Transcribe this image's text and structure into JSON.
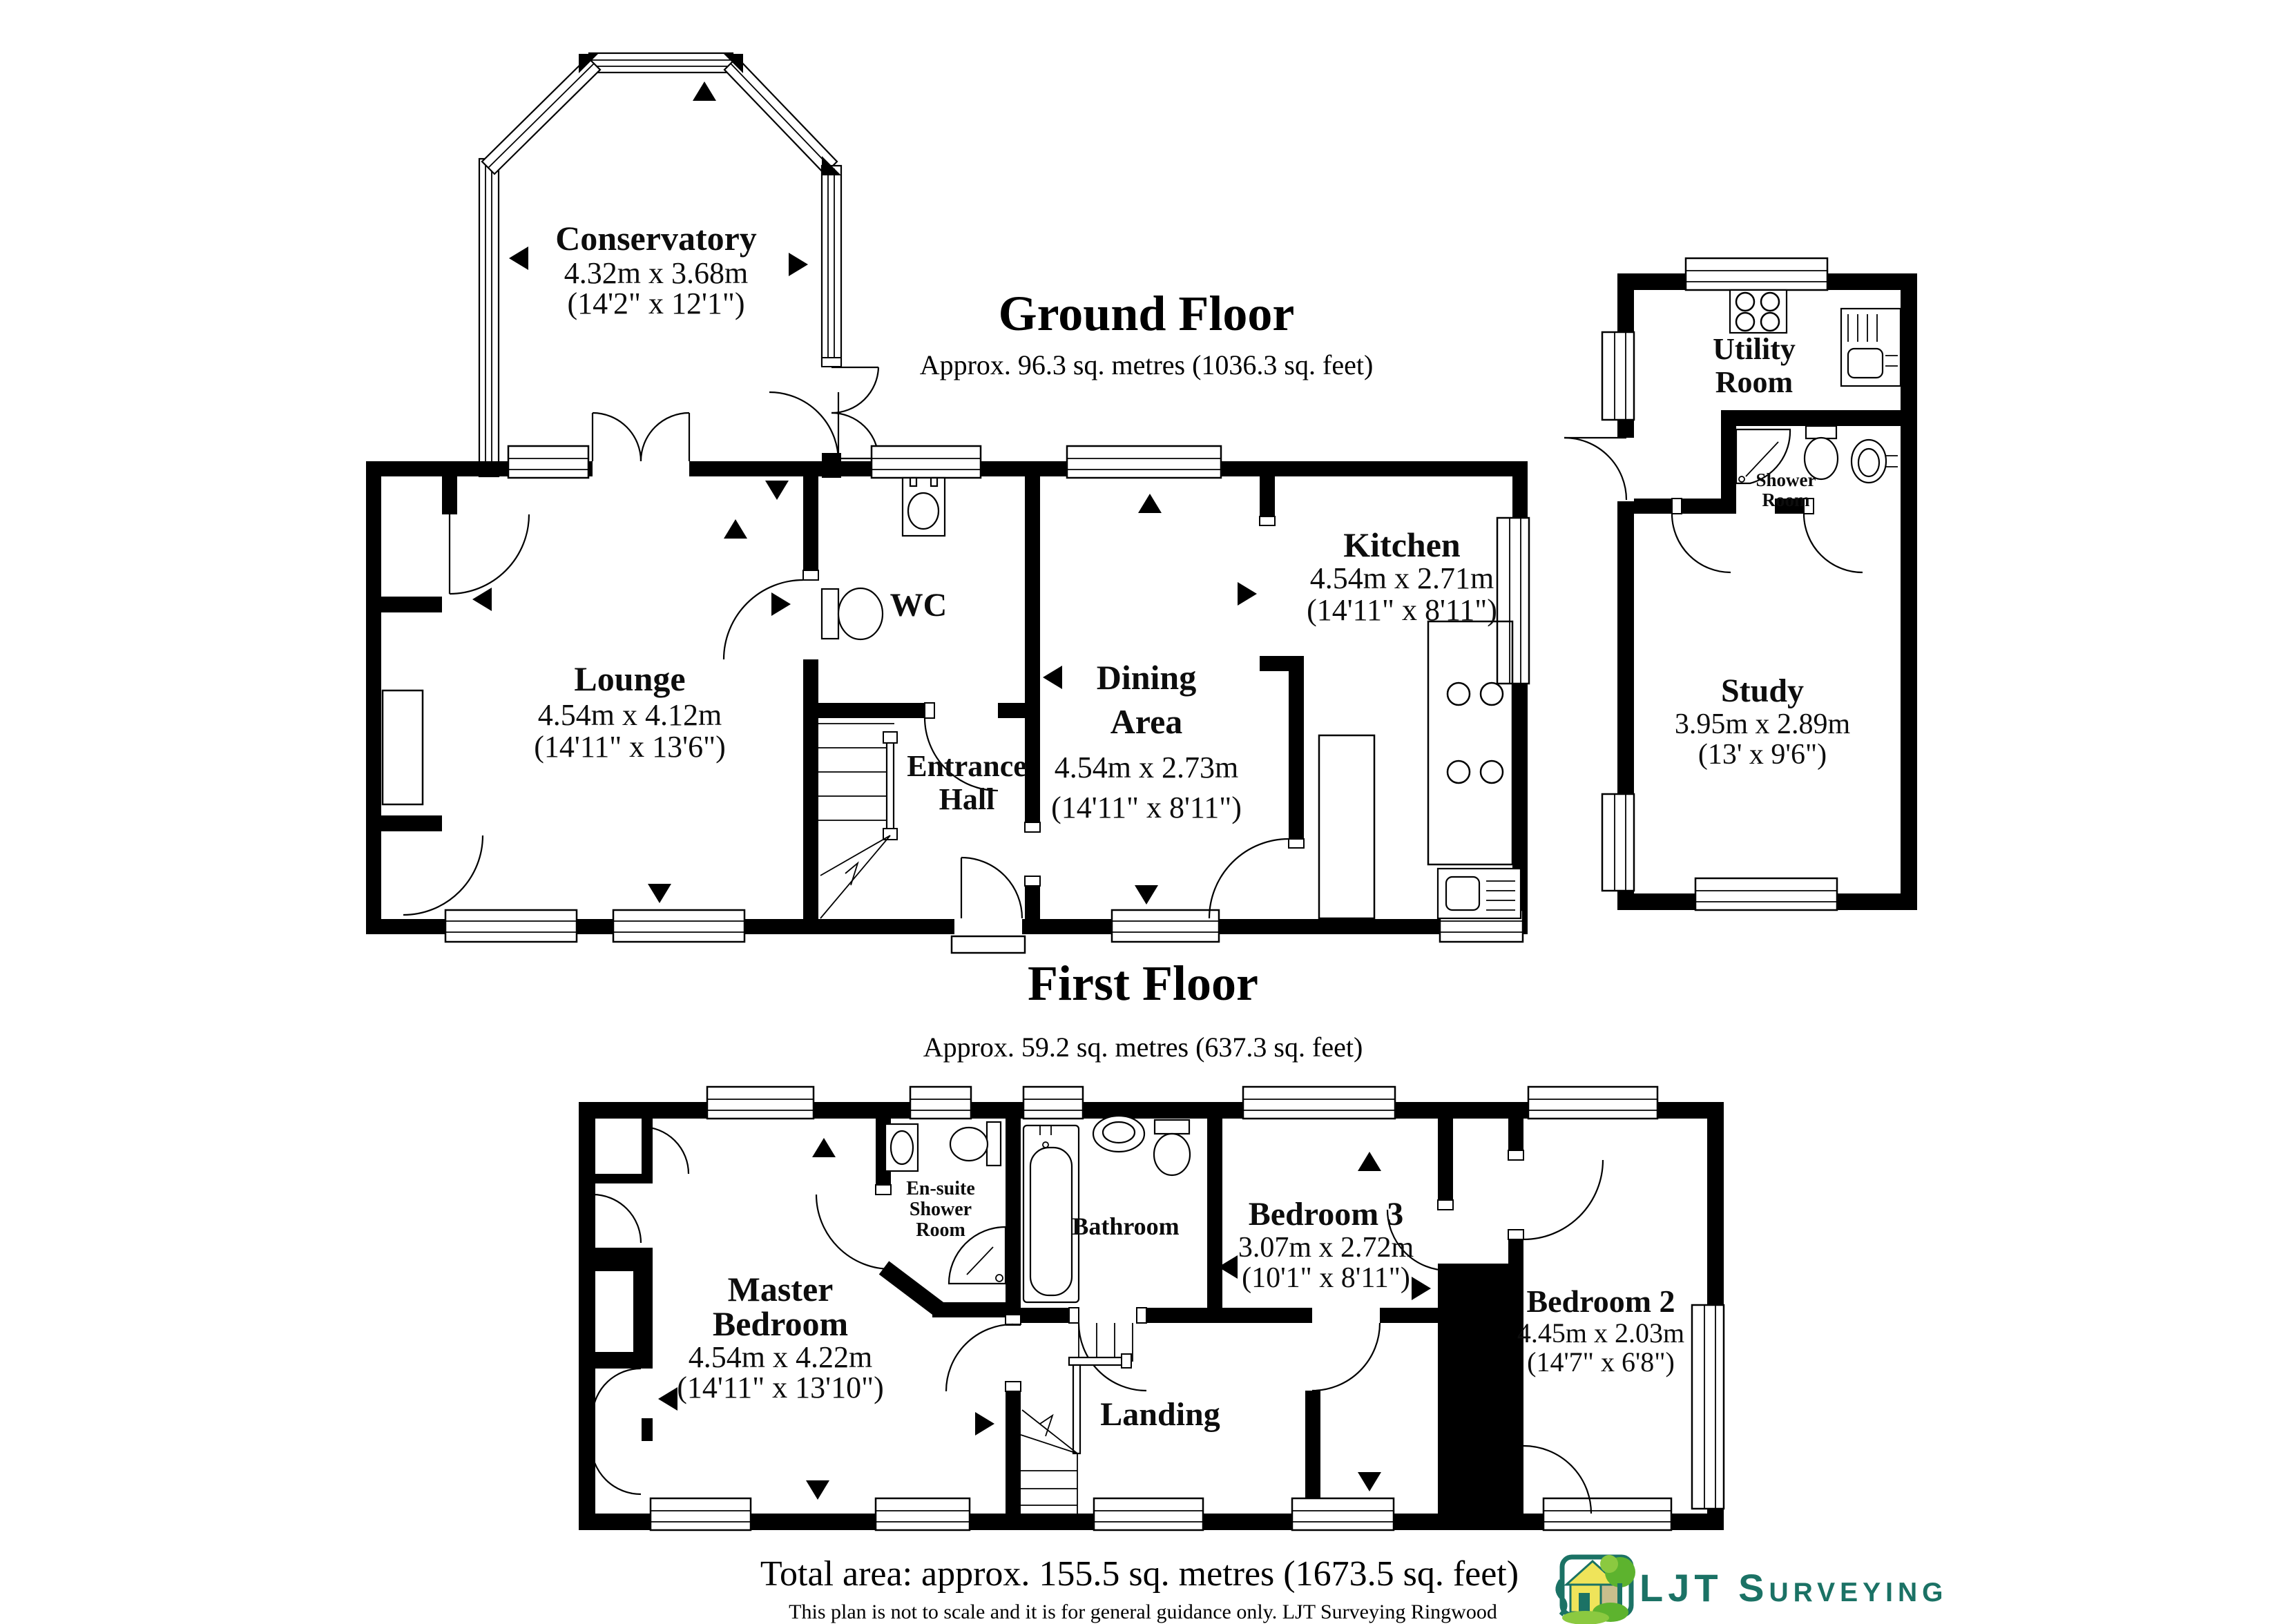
{
  "ground_floor": {
    "title": "Ground Floor",
    "subtitle": "Approx. 96.3 sq. metres (1036.3 sq. feet)",
    "rooms": {
      "conservatory": {
        "name": "Conservatory",
        "dim_m": "4.32m x 3.68m",
        "dim_ft": "(14'2\" x 12'1\")"
      },
      "lounge": {
        "name": "Lounge",
        "dim_m": "4.54m x 4.12m",
        "dim_ft": "(14'11\" x 13'6\")"
      },
      "wc": {
        "name": "WC"
      },
      "dining": {
        "line1": "Dining",
        "line2": "Area",
        "dim_m": "4.54m x 2.73m",
        "dim_ft": "(14'11\" x 8'11\")"
      },
      "kitchen": {
        "name": "Kitchen",
        "dim_m": "4.54m x 2.71m",
        "dim_ft": "(14'11\" x 8'11\")"
      },
      "entrance_hall": {
        "line1": "Entrance",
        "line2": "Hall"
      },
      "utility": {
        "line1": "Utility",
        "line2": "Room"
      },
      "shower_room": {
        "line1": "Shower",
        "line2": "Room"
      },
      "study": {
        "name": "Study",
        "dim_m": "3.95m x 2.89m",
        "dim_ft": "(13' x 9'6\")"
      }
    }
  },
  "first_floor": {
    "title": "First Floor",
    "subtitle": "Approx. 59.2 sq. metres (637.3 sq. feet)",
    "rooms": {
      "master": {
        "line1": "Master",
        "line2": "Bedroom",
        "dim_m": "4.54m x 4.22m",
        "dim_ft": "(14'11\" x 13'10\")"
      },
      "ensuite": {
        "line1": "En-suite",
        "line2": "Shower",
        "line3": "Room"
      },
      "bathroom": {
        "name": "Bathroom"
      },
      "bedroom3": {
        "name": "Bedroom 3",
        "dim_m": "3.07m x 2.72m",
        "dim_ft": "(10'1\" x 8'11\")"
      },
      "bedroom2": {
        "name": "Bedroom 2",
        "dim_m": "4.45m x 2.03m",
        "dim_ft": "(14'7\" x 6'8\")"
      },
      "landing": {
        "name": "Landing"
      }
    }
  },
  "footer": {
    "total_area": "Total area: approx. 155.5 sq. metres (1673.5 sq. feet)",
    "disclaimer": "This plan is not to scale and it is for general guidance only. LJT Surveying Ringwood"
  },
  "logo": {
    "text": "LJT Surveying",
    "teal": "#1B7265",
    "green": "#5DB32E",
    "light_green": "#8BC940",
    "yellow": "#EFE45A",
    "tan": "#C9BE8C"
  }
}
